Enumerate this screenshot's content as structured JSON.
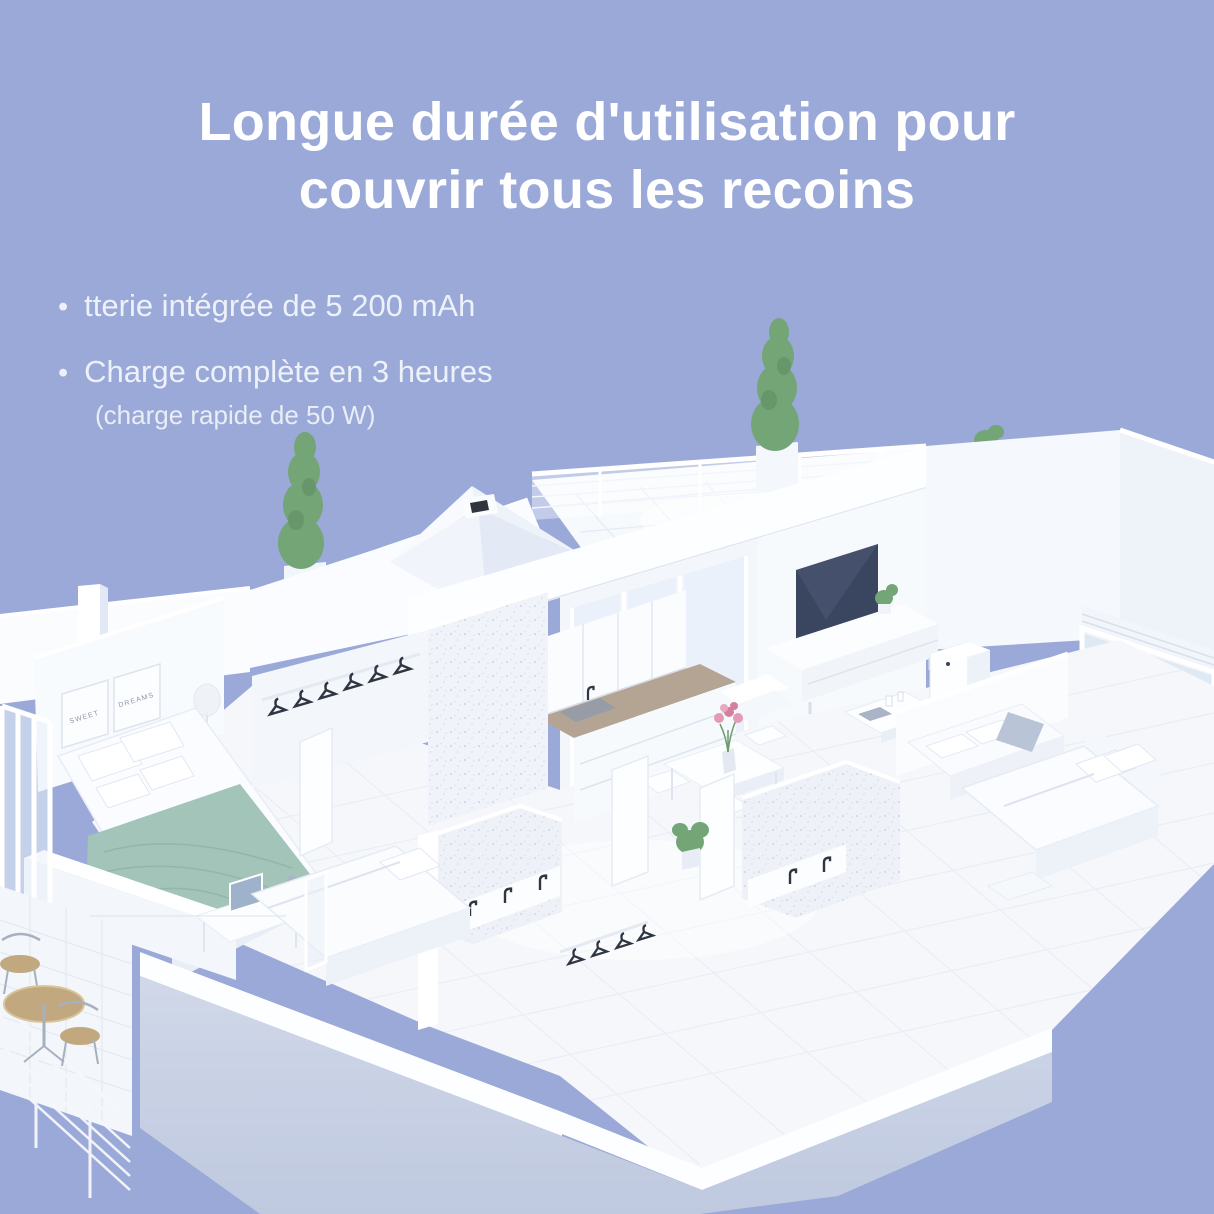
{
  "title": {
    "line1": "Longue durée d'utilisation pour",
    "line2": "couvrir tous les recoins",
    "color": "#ffffff"
  },
  "bullets": [
    {
      "text": "tterie intégrée de 5 200 mAh"
    },
    {
      "text": "Charge complète en 3 heures",
      "subtext": "(charge rapide de 50 W)"
    }
  ],
  "illustration": {
    "description": "Isometric 3D cutaway floor plan of an apartment with rooftop terrace, bedrooms, kitchen, living room, bathrooms and balcony; a white robot-vacuum dock stands in the living room",
    "frame_labels": {
      "left": "SWEET",
      "right": "DREAMS"
    },
    "colors": {
      "background": "#9aa9d8",
      "walls": "#ffffff",
      "wall_shadow": "#dfe6f2",
      "front_face": "#c9d2e5",
      "floor": "#f5f7fb",
      "blanket": "#a3c4b9",
      "tv_screen": "#3a4660",
      "plant": "#74a577",
      "wood": "#c2a87f",
      "counter": "#b3a494",
      "fixtures": "#2e3642"
    }
  }
}
